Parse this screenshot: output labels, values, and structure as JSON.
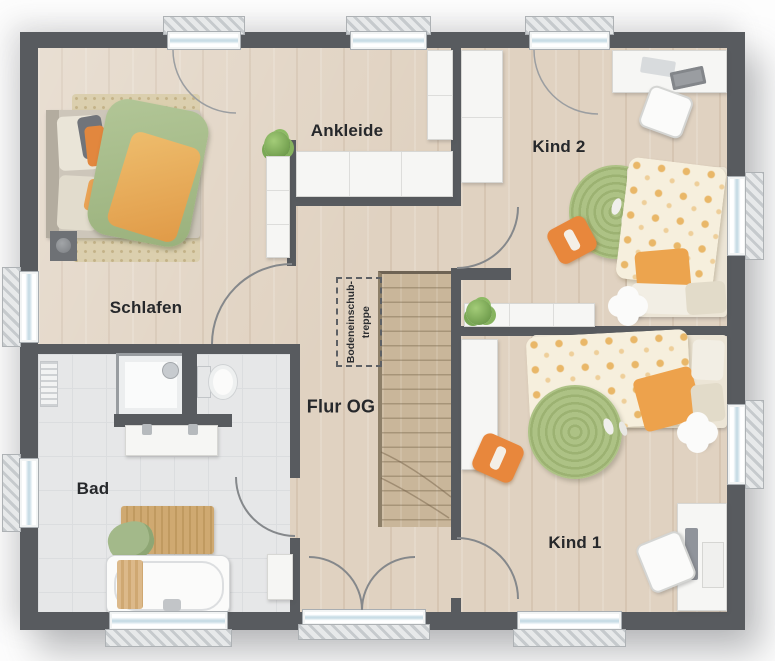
{
  "plan_title": "Obergeschoss Grundriss",
  "rooms": {
    "schlafen": {
      "label": "Schlafen"
    },
    "ankleide": {
      "label": "Ankleide"
    },
    "kind2": {
      "label": "Kind 2"
    },
    "kind1": {
      "label": "Kind 1"
    },
    "bad": {
      "label": "Bad"
    },
    "flur": {
      "label": "Flur OG"
    }
  },
  "attic_hatch": {
    "line1": "Bodeneinschub-",
    "line2": "treppe"
  },
  "colors": {
    "wall": "#585b5f",
    "wood_floor": "#e0d2c1",
    "tile_floor": "#e6e7e8",
    "stairs": "#c9b69a",
    "accent_orange": "#e8873c",
    "accent_green_duvet": "#a9bf8c",
    "kids_duvet_dots": "#e8b462",
    "rug_round_green": "#a5ba7c",
    "rug_beige": "#dbcfae",
    "furniture_white": "#f6f6f4",
    "window_glass": "#c9dde6",
    "door_arc": "#85888b",
    "label_text": "#26282b",
    "background": "#fdfdfd"
  }
}
